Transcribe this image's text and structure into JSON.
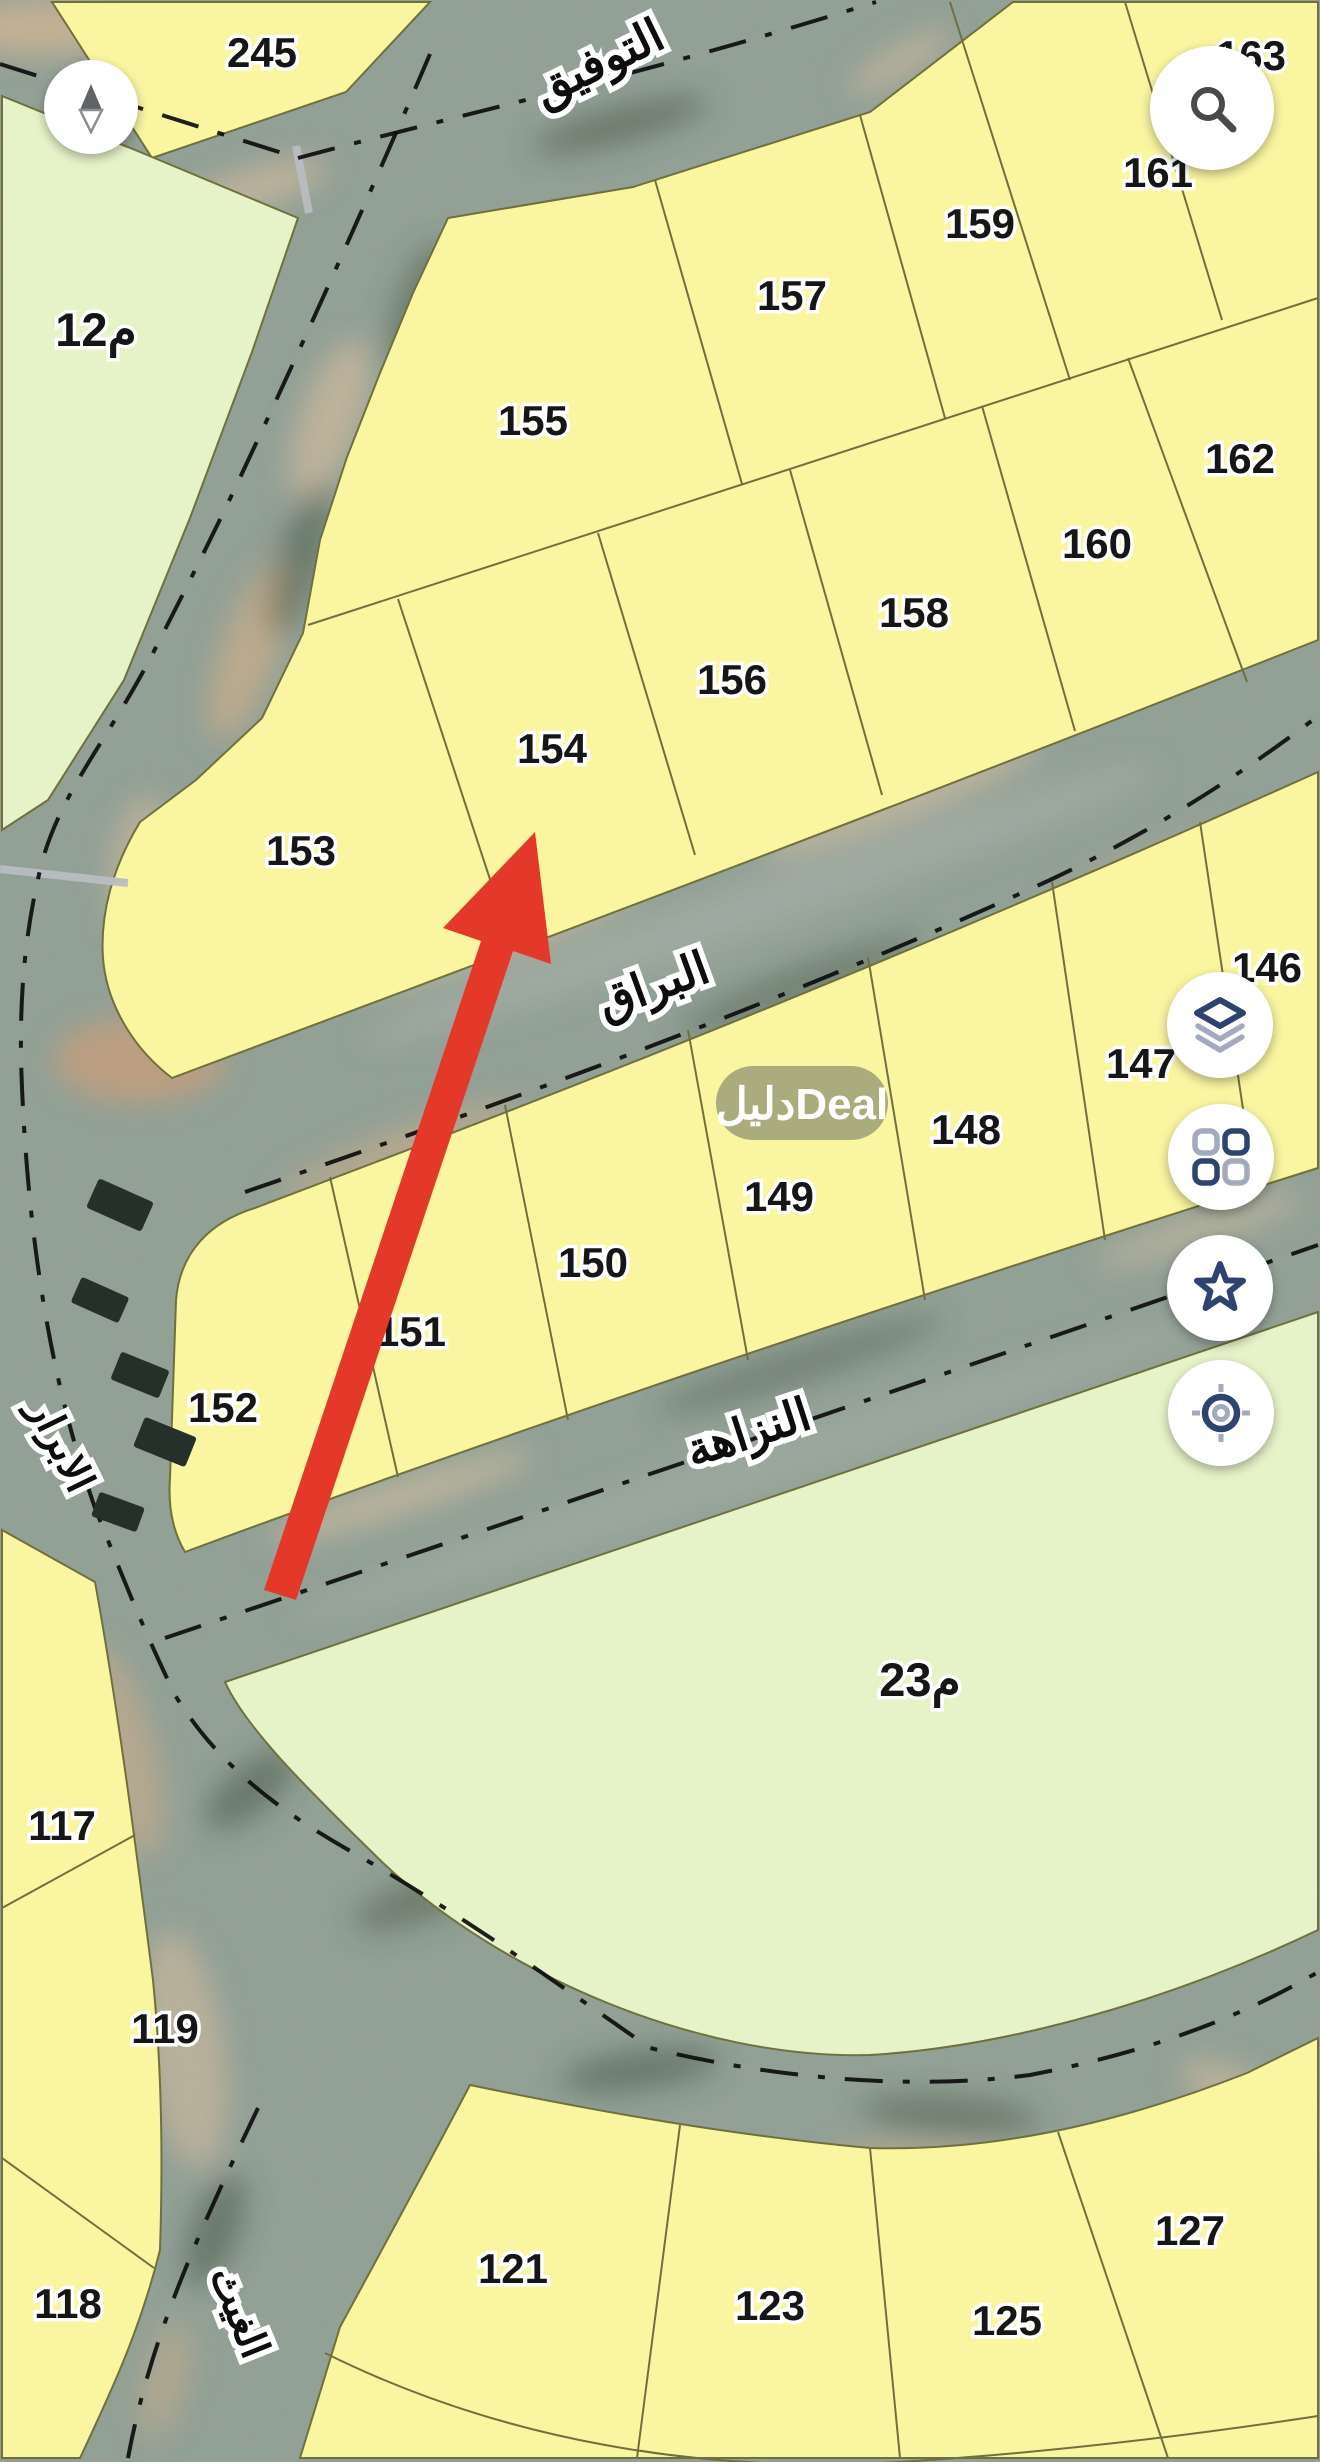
{
  "map": {
    "parcels": [
      {
        "label": "245"
      },
      {
        "label": "163"
      },
      {
        "label": "161"
      },
      {
        "label": "159"
      },
      {
        "label": "157"
      },
      {
        "label": "155"
      },
      {
        "label": "162"
      },
      {
        "label": "160"
      },
      {
        "label": "158"
      },
      {
        "label": "156"
      },
      {
        "label": "154"
      },
      {
        "label": "153"
      },
      {
        "label": "146"
      },
      {
        "label": "147"
      },
      {
        "label": "148"
      },
      {
        "label": "149"
      },
      {
        "label": "150"
      },
      {
        "label": "151"
      },
      {
        "label": "152"
      },
      {
        "label": "117"
      },
      {
        "label": "119"
      },
      {
        "label": "118"
      },
      {
        "label": "121"
      },
      {
        "label": "123"
      },
      {
        "label": "125"
      },
      {
        "label": "127"
      }
    ],
    "zones": [
      {
        "label": "12م"
      },
      {
        "label": "23م"
      }
    ],
    "streets": [
      {
        "name": "التوفيق"
      },
      {
        "name": "البراق"
      },
      {
        "name": "النزاهة"
      },
      {
        "name": "الابرار"
      },
      {
        "name": "الغيث"
      }
    ],
    "watermark": {
      "text": "دليلDeal"
    },
    "annotation": {
      "type": "red-arrow",
      "color": "#e4382b"
    }
  },
  "colors": {
    "parcel_yellow": "#f9f5a1",
    "zone_green": "#e6f2c8",
    "road_base": "#93a296",
    "boundary": "#70703e",
    "accent_navy": "#2e4370",
    "icon_gray": "#a3aabe",
    "arrow_red": "#e4382b"
  },
  "controls": {
    "compass": {
      "icon": "compass-north-icon"
    },
    "search": {
      "icon": "search-icon"
    },
    "layers": {
      "icon": "layers-icon"
    },
    "apps": {
      "icon": "grid-icon"
    },
    "favorites": {
      "icon": "star-icon"
    },
    "locate": {
      "icon": "locate-icon"
    }
  }
}
